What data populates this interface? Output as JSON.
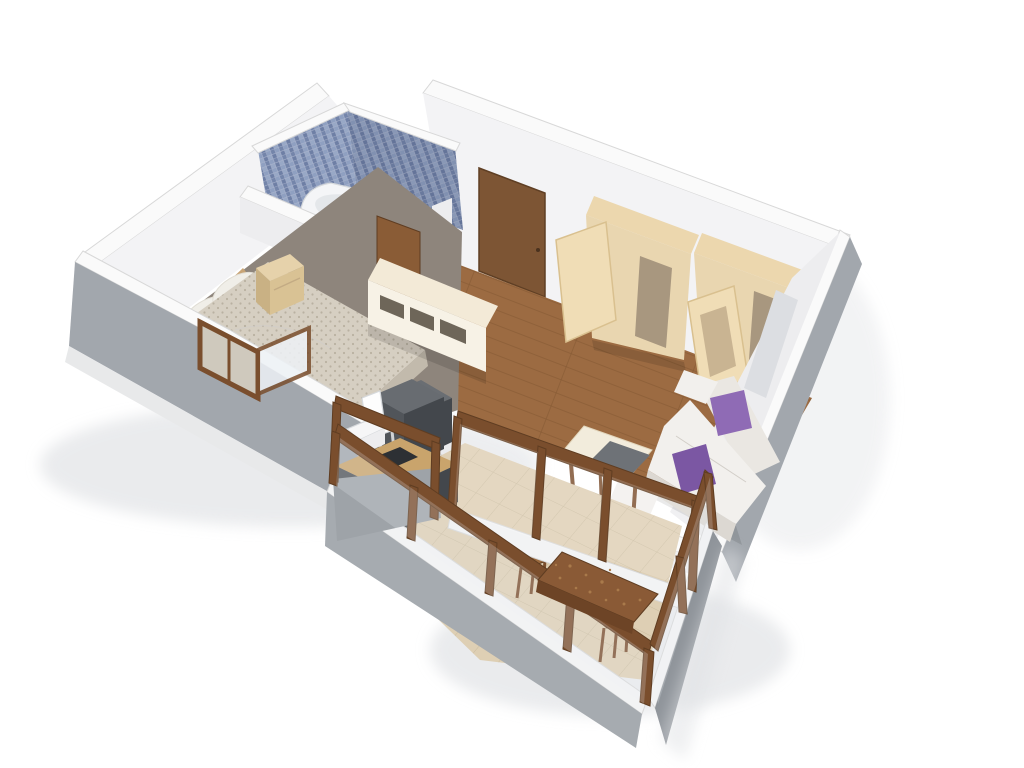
{
  "scene": {
    "kind": "3d-isometric-apartment-floor-plan-render",
    "background": "#ffffff",
    "rooms": [
      {
        "name": "bathroom",
        "features": [
          "blue-mosaic-walls",
          "bathtub",
          "toilet",
          "wood-shelf",
          "bathroom-door"
        ]
      },
      {
        "name": "bedroom",
        "features": [
          "double-bed",
          "headboard",
          "white-pillows",
          "stippled-blanket",
          "nightstand",
          "casement-window-open"
        ]
      },
      {
        "name": "hallway",
        "features": [
          "entry-door",
          "wood-plank-floor"
        ]
      },
      {
        "name": "living-room",
        "features": [
          "wardrobe-left-door-ajar",
          "wardrobe-right-door-ajar",
          "white-sofa",
          "purple-cushion-1",
          "purple-cushion-2",
          "coffee-table-with-gray-tray",
          "sideboard-wall-unit",
          "dark-tv-cabinet",
          "window-recess-right-wall"
        ]
      },
      {
        "name": "kitchenette",
        "features": [
          "tall-dark-cabinet",
          "oak-counter-with-sink",
          "white-hood-chair",
          "white-step-box"
        ]
      },
      {
        "name": "balcony",
        "features": [
          "wood-glazing-frames",
          "stone-tile-floor",
          "rustic-wood-table",
          "stool-1",
          "stool-2",
          "concrete-parapet"
        ]
      }
    ]
  },
  "palette": {
    "wall_top": "#fafafa",
    "wall_face": "#f3f3f5",
    "wall_face_dim": "#ededef",
    "wall_recess": "#dcdee2",
    "outer_gray": "#a2a7ad",
    "outer_gray_dark": "#8f949a",
    "plinth": "#e8e9ea",
    "door_entry": "#7d5534",
    "door_bath": "#8a5f38",
    "floor_wood": "#9c6b42",
    "floor_bedroom": "#8e857c",
    "tub_white": "#f4f5f7",
    "tub_inner": "#e4e7ea",
    "headboard": "#c8a476",
    "pillow_white": "#f0eee8",
    "blanket": "#d6cfc2",
    "blanket_side": "#c2baac",
    "nightstand_top": "#e6d2ab",
    "nightstand_front": "#d9c294",
    "nightstand_side": "#c9b184",
    "unit_top": "#f3ead7",
    "unit_front": "#f7f2e6",
    "unit_slot": "#6e6659",
    "panel_brown": "#8a5c36",
    "tv_top": "#6a6e73",
    "tv_front": "#54585d",
    "tv_side": "#43474c",
    "ward_top": "#ecd7ae",
    "ward_front": "#e9d6b0",
    "ward_door": "#f0ddb6",
    "ward_inset_light": "#c9b492",
    "ward_inset_dark": "#a8977f",
    "sofa_back": "#eae7e2",
    "sofa_seat": "#f2f0ed",
    "sofa_front": "#dcd8d2",
    "pillow_purple": "#8f6bb5",
    "pillow_purple_dark": "#7b57a3",
    "ctable_top": "#f2ecdc",
    "ctable_tray": "#6e7277",
    "frame_brown": "#7a4e2d",
    "glass": "#ffffff",
    "glass_pane": "#eef2f6",
    "counter_oak": "#c9a46c",
    "sink_dark": "#2d3034",
    "kitchen_top": "#686c71",
    "kitchen_front": "#51555a",
    "kitchen_side": "#43474c",
    "hood_white": "#fdfdfd",
    "step_white": "#f6f6f7",
    "balc_tile": "#decfb4",
    "sill_white": "#f2f3f4",
    "parapet_sw": "#a6abb0",
    "parapet_se": "#8f949a",
    "parapet_nw": "#9ea3a8",
    "rustic_top": "#8a5a36",
    "rustic_edge": "#6d4426",
    "stool_wood": "#9a6a3e",
    "window_fill": "#cfc9bd",
    "shadow_soft": "#dfe1e4",
    "shadow_dark": "#000000"
  }
}
